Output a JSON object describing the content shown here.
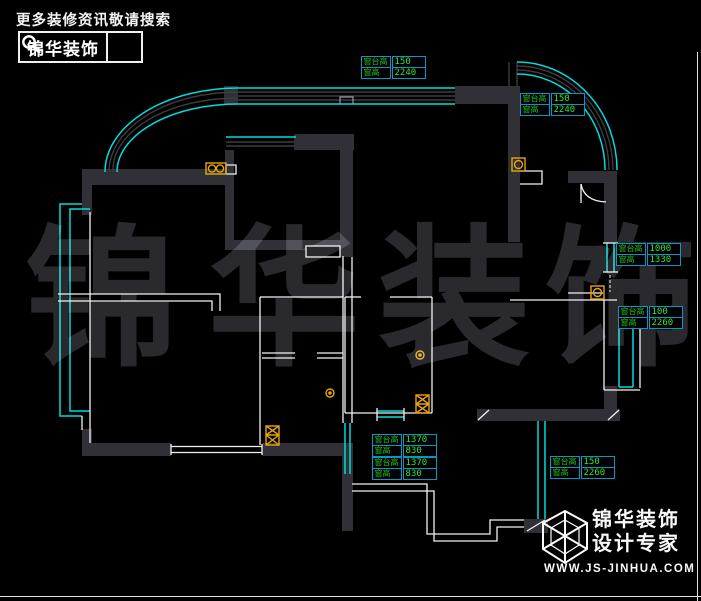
{
  "header": {
    "tagline": "更多装修资讯敬请搜索",
    "brand": "锦华装饰",
    "search_icon": "magnifier-icon"
  },
  "watermark": {
    "chars": [
      "锦",
      "华",
      "装",
      "饰"
    ]
  },
  "footer": {
    "brand": "锦华装饰",
    "slogan": "设计专家",
    "website": "WWW.JS-JINHUA.COM",
    "logo_icon": "wireframe-cube-icon"
  },
  "annotations": {
    "tables": [
      {
        "pos": "top-center",
        "rows": [
          {
            "label": "窗台高",
            "value": "150"
          },
          {
            "label": "窗高",
            "value": "2240"
          }
        ]
      },
      {
        "pos": "top-right",
        "rows": [
          {
            "label": "窗台高",
            "value": "150"
          },
          {
            "label": "窗高",
            "value": "2240"
          }
        ]
      },
      {
        "pos": "right-upper",
        "rows": [
          {
            "label": "窗台高",
            "value": "1000"
          },
          {
            "label": "窗高",
            "value": "1330"
          }
        ]
      },
      {
        "pos": "right-lower",
        "rows": [
          {
            "label": "窗台高",
            "value": "100"
          },
          {
            "label": "窗高",
            "value": "2260"
          }
        ]
      },
      {
        "pos": "bottom-center",
        "rows": [
          {
            "label": "窗台高",
            "value": "1370"
          },
          {
            "label": "窗高",
            "value": "830"
          },
          {
            "label": "窗台高",
            "value": "1370"
          },
          {
            "label": "窗高",
            "value": "830"
          }
        ]
      },
      {
        "pos": "bottom-right",
        "rows": [
          {
            "label": "窗台高",
            "value": "150"
          },
          {
            "label": "窗高",
            "value": "2260"
          }
        ]
      }
    ]
  },
  "floor_plan": {
    "symbols": [
      "double-socket-symbol",
      "switch-symbol",
      "drain-circle-symbol",
      "shaft-hatch-symbol",
      "door-swing-symbol",
      "curved-bay-window",
      "straight-window-band"
    ]
  },
  "colors": {
    "background": "#000000",
    "wall_fill": "#303036",
    "window_cyan": "#00dcdc",
    "thin_line_white": "#f2f2f2",
    "annotation_border": "#0a96c8",
    "annotation_text_green": "#28d828",
    "symbol_orange": "#e8a50f",
    "watermark_gray": "#2a2a2e",
    "logo_white": "#fafafa"
  }
}
